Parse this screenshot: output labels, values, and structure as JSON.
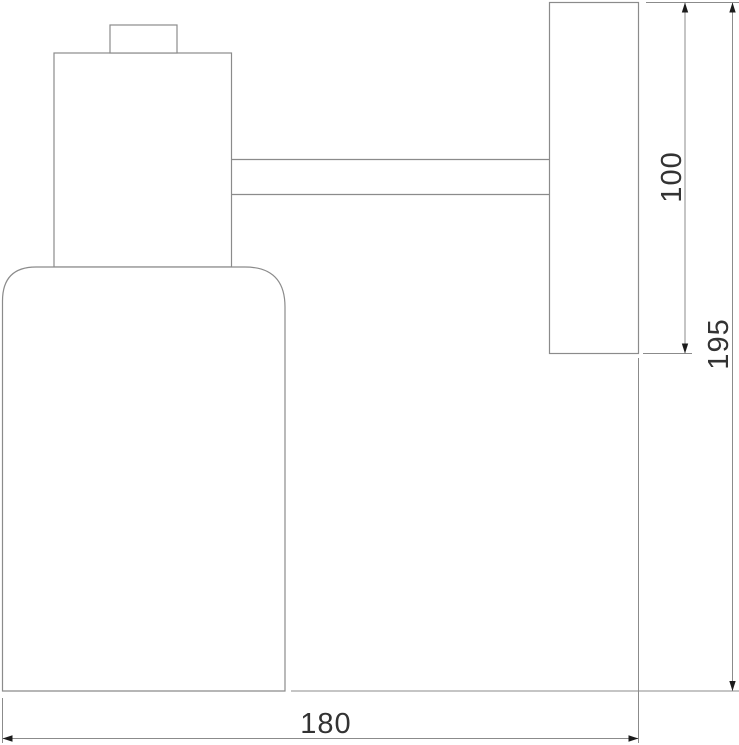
{
  "drawing": {
    "kind": "technical-dimension-drawing",
    "view": "side-elevation",
    "colors": {
      "background": "#ffffff",
      "outline": "#8b8b8b",
      "dimension_line": "#8b8b8b",
      "arrow": "#1c1c1c",
      "text": "#333333"
    },
    "dimension_labels": {
      "bracket_height": "100",
      "overall_height": "195",
      "overall_depth": "180"
    }
  }
}
